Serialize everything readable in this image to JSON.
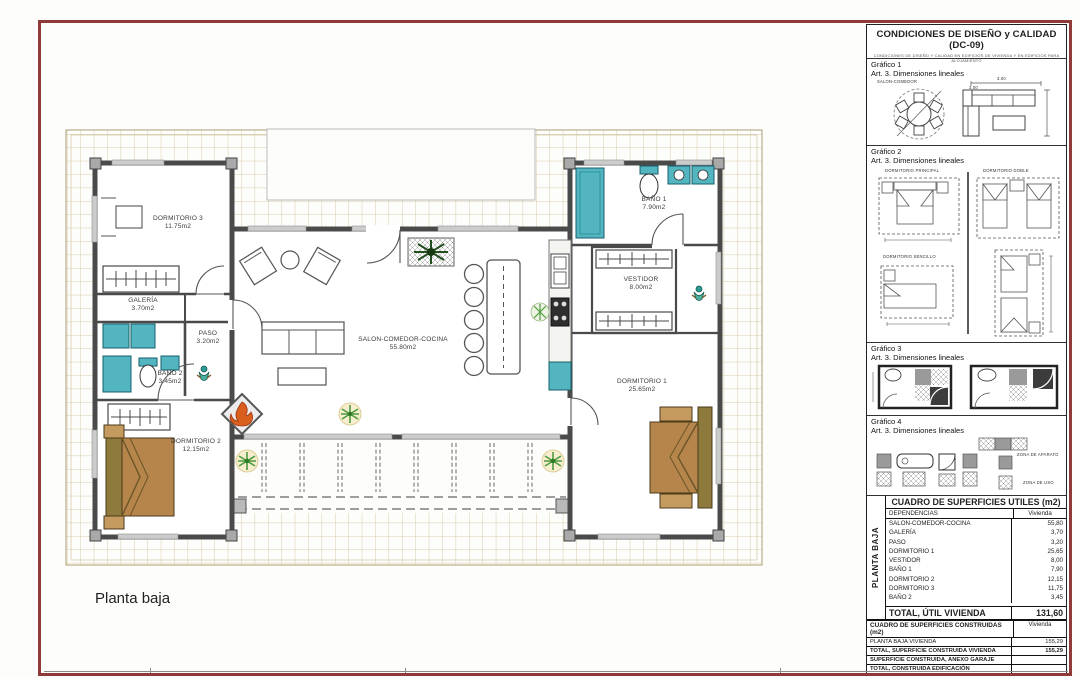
{
  "sheet": {
    "plan_title": "Planta baja"
  },
  "panel": {
    "title": "CONDICIONES DE DISEÑO y CALIDAD (DC-09)",
    "subtitle": "CONDICIONES DE DISEÑO Y CALIDAD EN EDIFICIOS DE VIVIENDA Y EN EDIFICIOS PARA ALOJAMIENTO",
    "graficos": [
      {
        "name": "Gráfico 1",
        "art": "Art. 3. Dimensiones lineales",
        "room_label": "SALON-COMEDOR",
        "dim": "3.00"
      },
      {
        "name": "Gráfico 2",
        "art": "Art. 3. Dimensiones lineales",
        "label_principal": "DORMITORIO PRINCIPAL",
        "label_doble": "DORMITORIO DOBLE",
        "label_sencillo": "DORMITORIO SENCILLO"
      },
      {
        "name": "Gráfico 3",
        "art": "Art. 3. Dimensiones lineales"
      },
      {
        "name": "Gráfico 4",
        "art": "Art. 3. Dimensiones lineales",
        "zona_aparato": "ZONA DE APARATO",
        "zona_uso": "ZONA DE USO"
      }
    ]
  },
  "rooms": [
    {
      "name": "DORMITORIO 3",
      "area": "11.75m2"
    },
    {
      "name": "GALERÍA",
      "area": "3.70m2"
    },
    {
      "name": "PASO",
      "area": "3.20m2"
    },
    {
      "name": "BAÑO 2",
      "area": "3.45m2"
    },
    {
      "name": "DORMITORIO 2",
      "area": "12.15m2"
    },
    {
      "name": "SALON-COMEDOR-COCINA",
      "area": "55.80m2"
    },
    {
      "name": "BAÑO 1",
      "area": "7.90m2"
    },
    {
      "name": "VESTIDOR",
      "area": "8.00m2"
    },
    {
      "name": "DORMITORIO 1",
      "area": "25.65m2"
    }
  ],
  "tables": {
    "utiles": {
      "title": "CUADRO DE SUPERFICIES UTILES (m2)",
      "side_label": "PLANTA BAJA",
      "col_label": "DEPENDENCIAS",
      "col_value": "Vivienda",
      "rows": [
        {
          "label": "SALON-COMEDOR-COCINA",
          "value": "55,80"
        },
        {
          "label": "GALERÍA",
          "value": "3,70"
        },
        {
          "label": "PASO",
          "value": "3,20"
        },
        {
          "label": "DORMITORIO 1",
          "value": "25,65"
        },
        {
          "label": "VESTIDOR",
          "value": "8,00"
        },
        {
          "label": "BAÑO 1",
          "value": "7,90"
        },
        {
          "label": "DORMITORIO 2",
          "value": "12,15"
        },
        {
          "label": "DORMITORIO 3",
          "value": "11,75"
        },
        {
          "label": "BAÑO 2",
          "value": "3,45"
        }
      ],
      "total_label": "TOTAL, ÚTIL VIVIENDA",
      "total_value": "131,60"
    },
    "construidas": {
      "title": "CUADRO DE SUPERFICIES CONSTRUIDAS (m2)",
      "col_value": "Vivienda",
      "rows": [
        {
          "label": "PLANTA BAJA VIVIENDA",
          "value": "155,29"
        },
        {
          "label": "TOTAL, SUPERFICIE CONSTRUIDA VIVIENDA",
          "value": "155,29"
        },
        {
          "label": "SUPERFICIE CONSTRUIDA, ANEXO GARAJE",
          "value": ""
        },
        {
          "label": "TOTAL, CONSTRUIDA EDIFICACIÓN",
          "value": ""
        }
      ]
    }
  },
  "colors": {
    "frame_maroon": "#8e3a38",
    "tile_line": "#d9cda9",
    "wall": "#4a4a4a",
    "fixture_teal": "#53b5bf",
    "bed_brown": "#b5854c",
    "fireplace_orange": "#d85f1e",
    "plant_green": "#4f9a3e"
  }
}
